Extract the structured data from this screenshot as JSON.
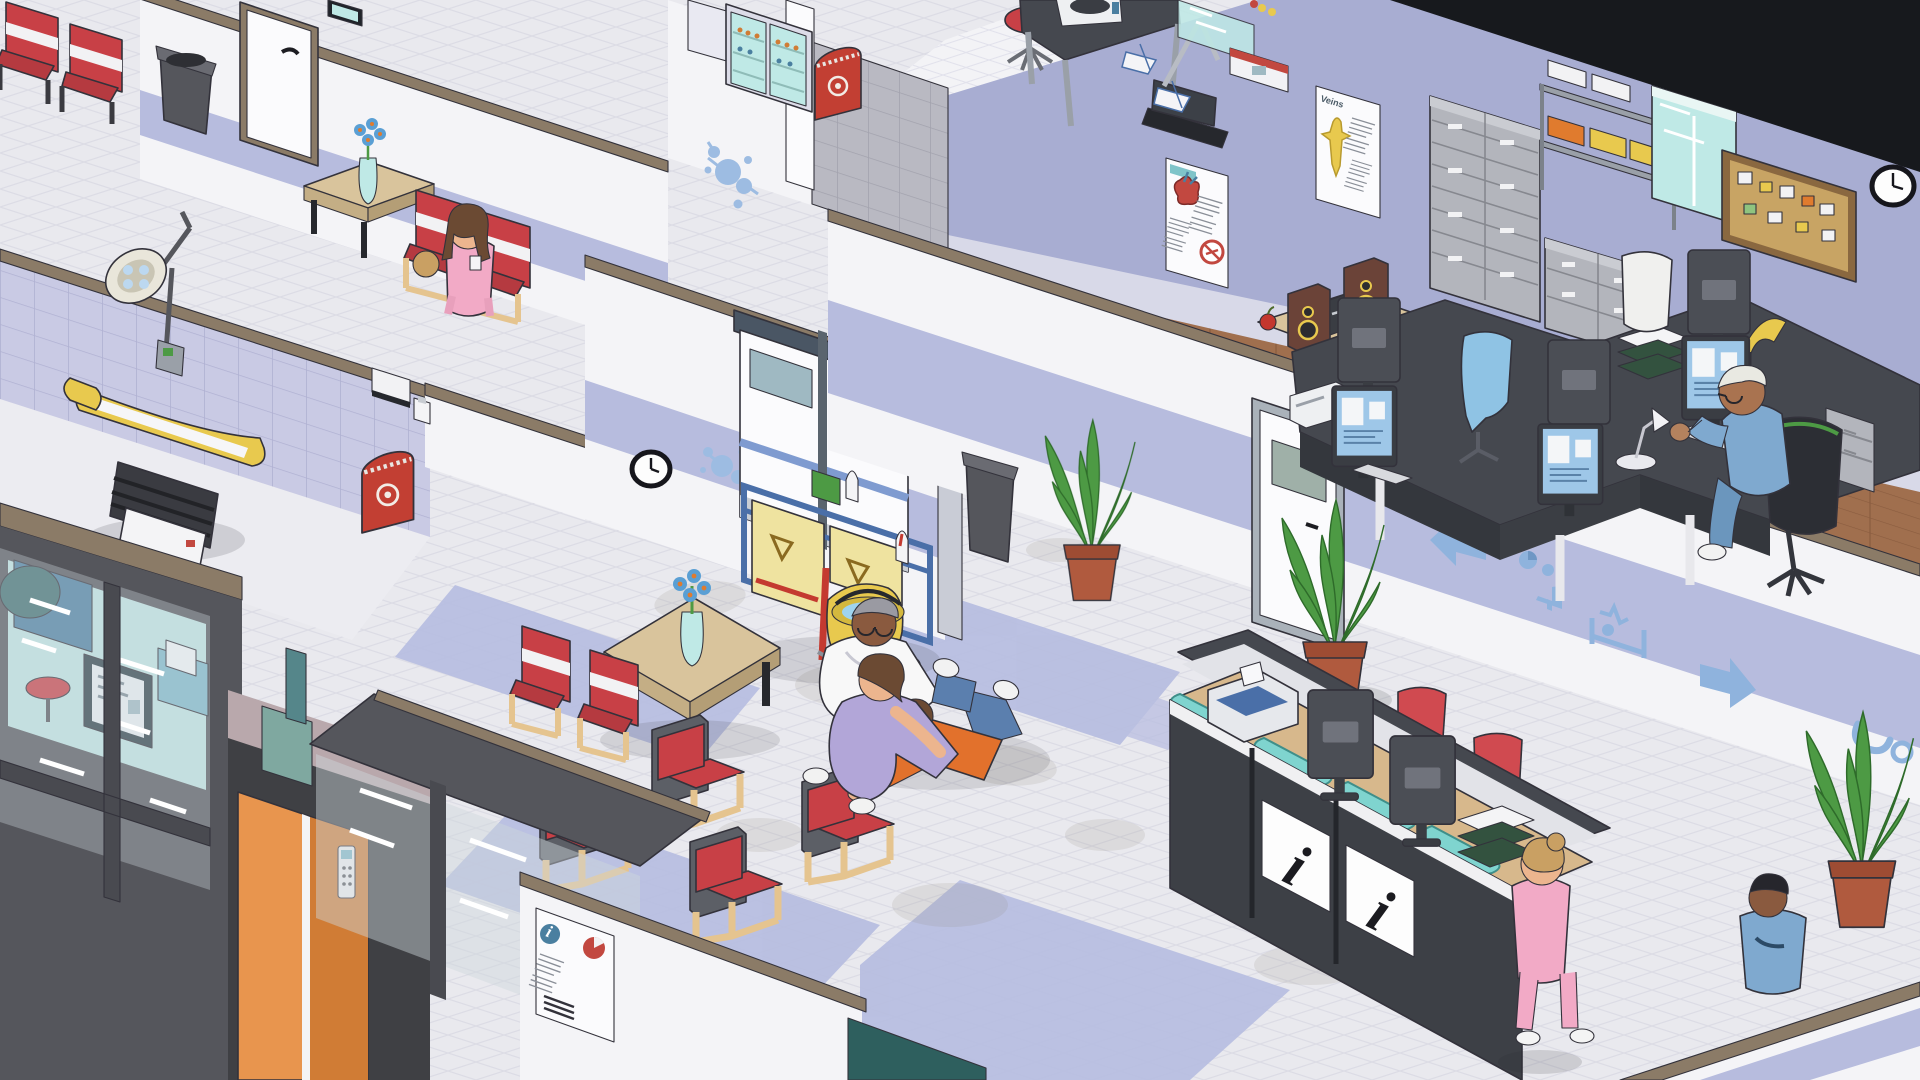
{
  "app": {
    "type": "isometric hospital simulation game",
    "view": "cutaway interior scene, no HUD visible"
  },
  "palette": {
    "wall": "#f4f4f7",
    "wall_band": "#b7bcde",
    "wall_lavender": "#a8add2",
    "tile_wall": "#c9cae4",
    "tile_gray": "#b9b9c2",
    "floor": "#e9e9ee",
    "floor_inlay": "#b6bce0",
    "floor_wood": "#a06f4e",
    "floor_lab": "#f3f3f6",
    "trim": "#8b7b67",
    "glass": "#bfe9e6",
    "counter_glass": "#7fd4cf",
    "desk_charcoal": "#45484f",
    "counter_wood": "#d7b88c",
    "chair_red": "#c84046",
    "chair_frame_tan": "#e5c48f",
    "biohazard_red": "#c23f33",
    "decal_blue": "#9dbce2",
    "plant": "#4d9a44",
    "pot": "#b05a3e",
    "elevator_orange": "#e8954e",
    "outside_dark": "#17191d"
  },
  "signage": {
    "info_desk_symbol": "i",
    "posters": [
      {
        "id": "heart-anatomy-poster",
        "location": "staff office wall",
        "elements": [
          "heart illustration",
          "no-smoking symbol",
          "text columns"
        ]
      },
      {
        "id": "veins-anatomy-poster",
        "title": "Veins",
        "location": "staff office wall",
        "elements": [
          "human figure",
          "text columns"
        ]
      },
      {
        "id": "eye-nutrition-poster",
        "location": "corridor wall",
        "elements": [
          "eye diagram",
          "carrot illustration",
          "text columns"
        ]
      },
      {
        "id": "patient-info-poster",
        "location": "lower wall",
        "elements": [
          "info symbol",
          "pie chart",
          "text lines",
          "barcode"
        ]
      }
    ],
    "wayfinding_decals": [
      "arrow-left",
      "waiting-area",
      "ward-bed",
      "arrow-right",
      "stethoscope"
    ],
    "wall_decals": [
      "bacteria",
      "bacteria",
      "stethoscope",
      "person-dot"
    ]
  },
  "areas": [
    {
      "name": "upper corridor",
      "objects": [
        "red waiting chairs",
        "trash bin",
        "door",
        "framed picture",
        "side table with flower vase",
        "red chairs"
      ],
      "people": [
        "woman in pink scrubs seated",
        "second visitor partially visible"
      ]
    },
    {
      "name": "examination room",
      "walls": "lavender tile",
      "objects": [
        "examination table",
        "procedure lamp",
        "paper towel dispenser",
        "soap dispenser",
        "biohazard bin"
      ]
    },
    {
      "name": "laboratory",
      "objects": [
        "medicine fridge",
        "biohazard bin",
        "lab stool",
        "lab table with centrifuge",
        "sample analyzer",
        "glass partition",
        "benchtop analyzer"
      ]
    },
    {
      "name": "staff office",
      "floor": "wood",
      "objects": [
        "stereo system",
        "apple",
        "file cabinets",
        "supply shelf with bins",
        "display cabinet",
        "cork board",
        "wall clock",
        "desk cluster",
        "five monitors",
        "desk lamps",
        "paper trays",
        "printer",
        "blue office chair",
        "white office chair",
        "drawer unit"
      ],
      "people": [
        "elderly doctor in blue scrubs typing at computer"
      ]
    },
    {
      "name": "waiting room",
      "objects": [
        "wall clock",
        "double doors",
        "janitor cart with mop bucket",
        "coffee table with flower vase",
        "six red waiting chairs",
        "trash bin"
      ],
      "people": [
        "doctor in white coat kneeling",
        "nurse in lavender scrubs kneeling",
        "collapsed patient in orange shirt lying on floor"
      ]
    },
    {
      "name": "main corridor",
      "objects": [
        "gray door with window",
        "two potted plants"
      ]
    },
    {
      "name": "reception",
      "objects": [
        "reception desk with info panels",
        "teal counter pads",
        "two monitors",
        "printer",
        "two red task chairs",
        "paper trays",
        "potted plant"
      ],
      "people": [
        "nurse in pink scrubs walking",
        "man in blue scrubs seated"
      ]
    },
    {
      "name": "imaging room",
      "objects": [
        "glass walls",
        "wall monitor",
        "imaging console",
        "blue cabinet",
        "machine gantry",
        "red stool",
        "orange elevator doors",
        "keypad",
        "planter"
      ]
    }
  ],
  "people": [
    {
      "id": "seated-woman",
      "outfit": "pink scrubs",
      "hair": "long brown",
      "extras": [
        "id badge"
      ]
    },
    {
      "id": "kneeling-doctor",
      "outfit": "white coat",
      "hair": "gray",
      "extras": [
        "glasses",
        "dark skin"
      ]
    },
    {
      "id": "kneeling-nurse",
      "outfit": "lavender scrubs",
      "hair": "short brown"
    },
    {
      "id": "collapsed-patient",
      "outfit": "orange shirt, blue jeans, white sneakers",
      "pose": "lying on floor"
    },
    {
      "id": "desk-doctor",
      "outfit": "blue scrubs",
      "hair": "white",
      "extras": [
        "glasses"
      ]
    },
    {
      "id": "walking-nurse",
      "outfit": "pink scrubs",
      "hair": "blonde bun"
    },
    {
      "id": "seated-man",
      "outfit": "blue scrubs",
      "hair": "dark",
      "extras": [
        "dark skin"
      ]
    }
  ]
}
